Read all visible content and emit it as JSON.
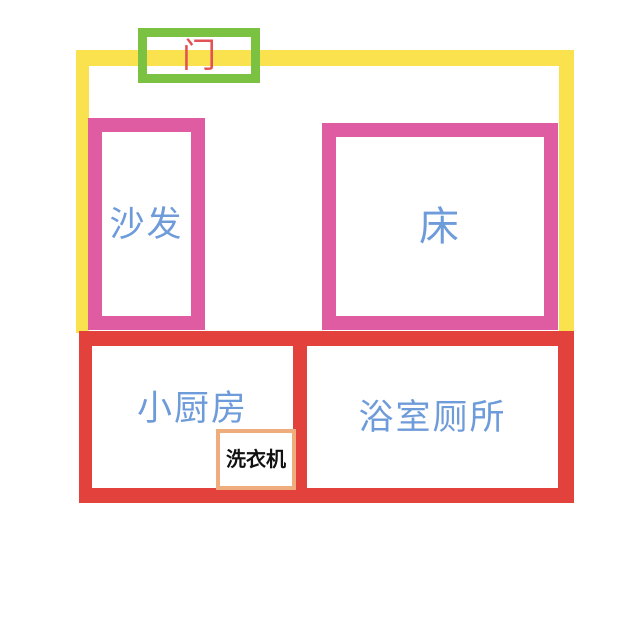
{
  "floorplan": {
    "door": {
      "label": "门"
    },
    "sofa": {
      "label": "沙发"
    },
    "bed": {
      "label": "床"
    },
    "kitchen": {
      "label": "小厨房"
    },
    "bathroom": {
      "label": "浴室厕所"
    },
    "washer": {
      "label": "洗衣机"
    },
    "colors": {
      "wall_yellow": "#F9E24E",
      "furniture_pink": "#E05CA2",
      "section_red": "#E3413B",
      "door_green": "#7CC242",
      "door_text_red": "#E25255",
      "label_blue": "#6E9BD9",
      "washer_orange": "#EFAD7D",
      "washer_text_black": "#111111",
      "background_white": "#FFFFFF"
    }
  }
}
